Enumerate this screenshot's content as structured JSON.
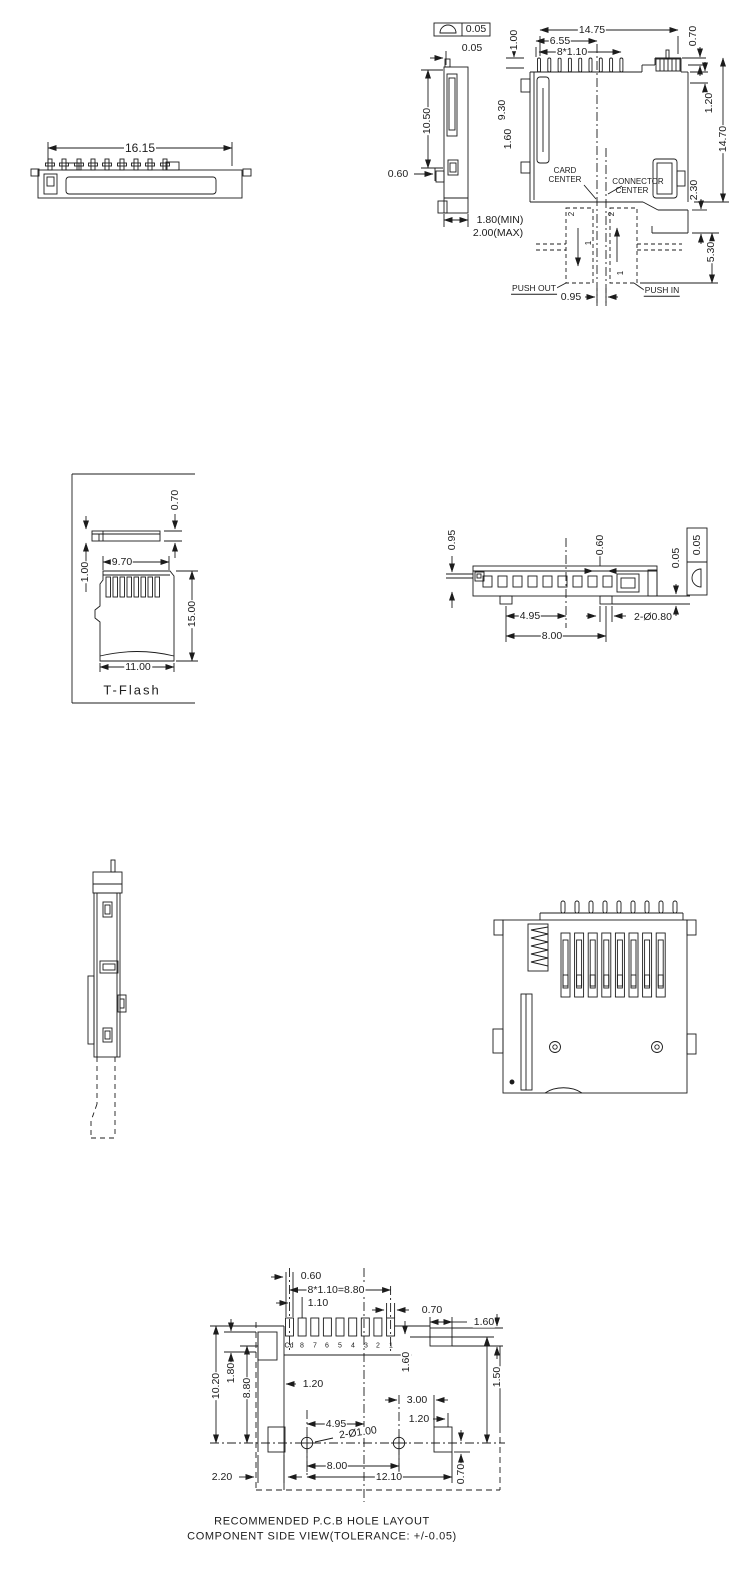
{
  "drawing": {
    "front_view": {
      "width": "16.15"
    },
    "side_view": {
      "flatness_tol": "0.05",
      "seam_offset": "0.05",
      "pin_height": "1.00",
      "body_width": "14.75",
      "pin_to_center": "6.55",
      "pin_pitch": "8*1.10",
      "right_step": "0.70",
      "side_height": "10.50",
      "body_height": "9.30",
      "left_step": "1.60",
      "right_lip": "1.20",
      "total_height": "14.70",
      "tab_width": "0.60",
      "throat_depth": "2.30",
      "travel": "5.30",
      "thickness_min": "1.80(MIN)",
      "thickness_max": "2.00(MAX)",
      "center_offset": "0.95",
      "card_center_1": "CARD",
      "card_center_2": "CENTER",
      "connector_center_1": "CONNECTOR",
      "connector_center_2": "CENTER",
      "push_out": "PUSH OUT",
      "push_in": "PUSH IN",
      "pos2": "2",
      "pos1": "1"
    },
    "t_flash": {
      "thickness_full": "1.00",
      "thickness": "0.70",
      "contact_width": "9.70",
      "length": "15.00",
      "width": "11.00",
      "label": "T-Flash"
    },
    "bottom_view": {
      "card_gap": "0.95",
      "pin_width": "0.60",
      "coplanarity": "0.05",
      "tol_value": "0.05",
      "foot_to_center": "4.95",
      "foot_span": "8.00",
      "holes": "2-Ø0.80"
    },
    "pcb_layout": {
      "cd_offset": "0.60",
      "pitch_total": "8*1.10=8.80",
      "pitch": "1.10",
      "pad_width": "0.70",
      "tab_width": "1.60",
      "pad_drop": "1.60",
      "tab_height": "1.50",
      "left_height": "10.20",
      "pad_height": "1.80",
      "left_span": "8.80",
      "left_offset": "1.20",
      "right_gap": "3.00",
      "tab_gap": "1.20",
      "hole_to_center": "4.95",
      "holes": "2-Ø1.00",
      "hole_span": "8.00",
      "total_span": "12.10",
      "edge_offset": "2.20",
      "tab_drop": "0.70",
      "pins": [
        "Cd",
        "8",
        "7",
        "6",
        "5",
        "4",
        "3",
        "2",
        "1"
      ],
      "caption_1": "RECOMMENDED  P.C.B  HOLE  LAYOUT",
      "caption_2": "COMPONENT  SIDE  VIEW(TOLERANCE:  +/-0.05)"
    }
  }
}
